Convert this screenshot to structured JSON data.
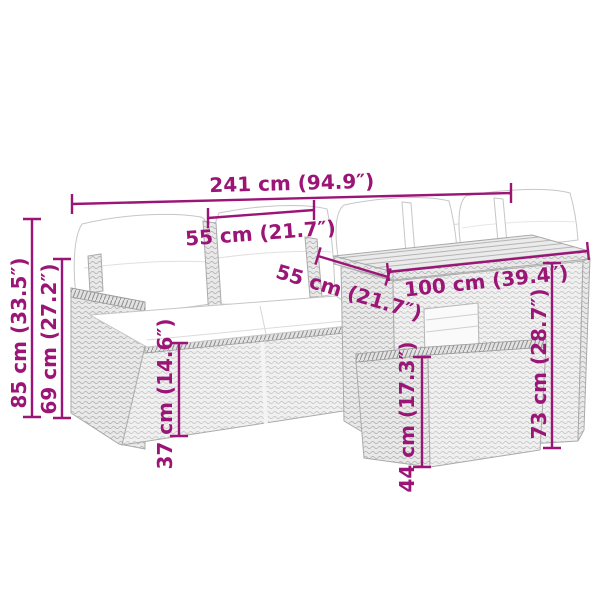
{
  "diagram": {
    "type": "product-dimension-diagram",
    "product": "5-piece rattan garden lounge set with sofa, table and ottoman",
    "dimensions": {
      "total_width": "241 cm (94.9″)",
      "seat_width": "55 cm (21.7″)",
      "table_depth": "55 cm (21.7″)",
      "table_width": "100 cm (39.4″)",
      "total_height": "85 cm (33.5″)",
      "back_height": "69 cm (27.2″)",
      "seat_height": "37 cm (14.6″)",
      "ottoman_height": "44 cm (17.3″)",
      "table_height": "73 cm (28.7″)"
    },
    "colors": {
      "dimension_accent": "#9b1577",
      "line_art": "#b0b0b0",
      "background": "#ffffff"
    }
  }
}
